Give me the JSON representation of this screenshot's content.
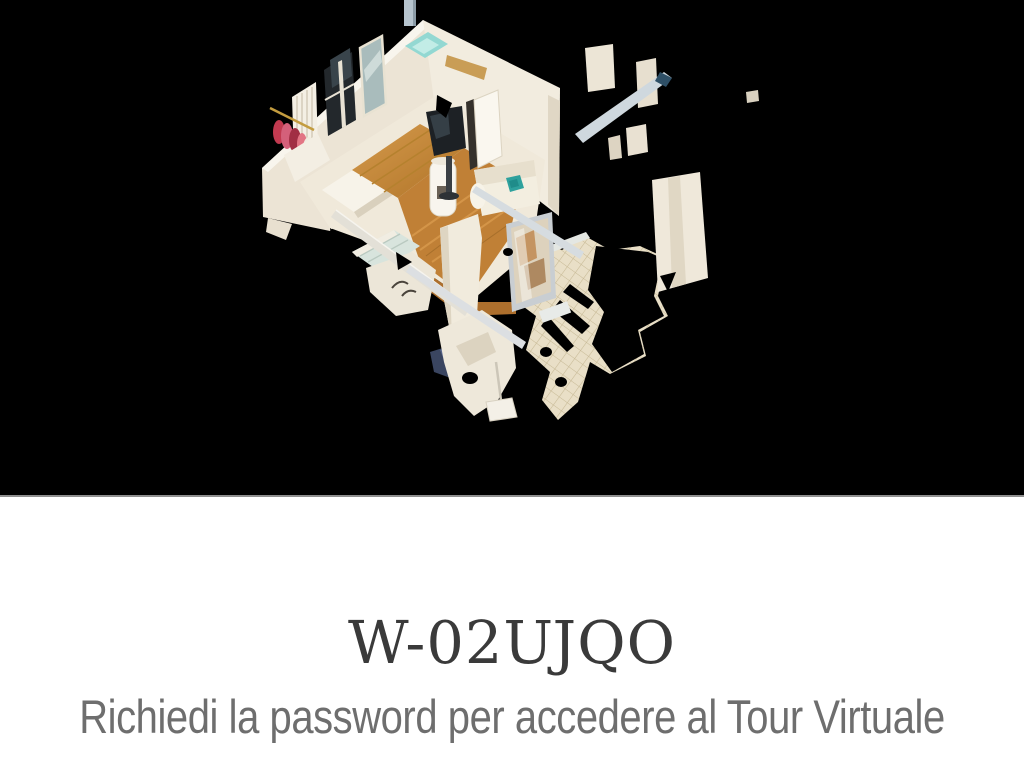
{
  "tour": {
    "code": "W-02UJQO",
    "password_prompt": "Richiedi la password per accedere al Tour Virtuale"
  },
  "hero": {
    "type": "3d-dollhouse-model-preview",
    "background_color": "#000000"
  },
  "colors": {
    "title_text": "#3a3a3a",
    "prompt_text": "#6e6e6e",
    "divider": "#8f8f8f",
    "section_background": "#ffffff",
    "wall": "#ece4d5",
    "wood_floor": "#c08036",
    "terrace_tile": "#e9dfc7",
    "sofa_pillow_teal": "#2ea19d",
    "clothes_red": "#c23a50"
  }
}
